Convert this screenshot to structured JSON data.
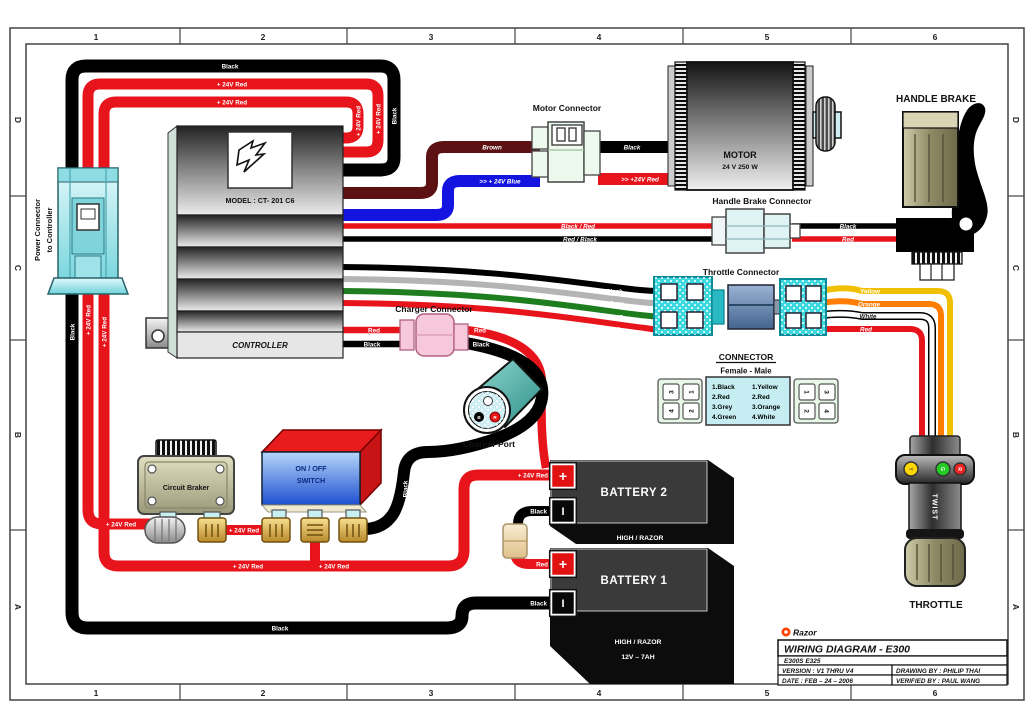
{
  "frame": {
    "columns": [
      "1",
      "2",
      "3",
      "4",
      "5",
      "6"
    ],
    "rows": [
      "D",
      "C",
      "B",
      "A"
    ]
  },
  "title_block": {
    "brand": "Razor",
    "title": "WIRING DIAGRAM - E300",
    "models": "E300S E325",
    "version": "VERSION : V1 THRU V4",
    "date": "DATE : FEB – 24 – 2006",
    "drawing_by": "DRAWING BY : PHILIP THAI",
    "verified_by": "VERIFIED BY : PAUL WANG"
  },
  "components": {
    "power_connector": {
      "label_line1": "Power Connector",
      "label_line2": "to Controller"
    },
    "controller": {
      "model": "MODEL : CT- 201 C6",
      "name": "CONTROLLER"
    },
    "motor_connector": {
      "label": "Motor Connector"
    },
    "motor": {
      "name": "MOTOR",
      "spec": "24 V 250 W"
    },
    "handle_brake": {
      "label": "HANDLE BRAKE"
    },
    "handle_brake_connector": {
      "label": "Handle Brake Connector"
    },
    "throttle_connector": {
      "label": "Throttle Connector"
    },
    "legend": {
      "title": "CONNECTOR",
      "subtitle": "Female  -  Male",
      "female_grid": [
        "3",
        "1",
        "4",
        "2"
      ],
      "male_grid": [
        "1",
        "3",
        "2",
        "4"
      ],
      "female_list": [
        "1.Black",
        "2.Red",
        "3.Grey",
        "4.Green"
      ],
      "male_list": [
        "1.Yellow",
        "2.Red",
        "3.Orange",
        "4.White"
      ]
    },
    "charger_connector": {
      "label": "Charger Connector"
    },
    "charger_port": {
      "label": "Charger Port",
      "pin_b": "B",
      "pin_r": "R"
    },
    "circuit_breaker": {
      "label": "Circuit Braker"
    },
    "power_switch": {
      "line1": "ON / OFF",
      "line2": "SWITCH"
    },
    "battery2": {
      "name": "BATTERY 2",
      "plus": "+",
      "minus": "I",
      "caption": "HIGH / RAZOR"
    },
    "battery1": {
      "name": "BATTERY 1",
      "plus": "+",
      "minus": "I",
      "caption1": "HIGH / RAZOR",
      "caption2": "12V – 7AH"
    },
    "throttle": {
      "label": "THROTTLE",
      "grip_text": "TWIST",
      "led_yellow": "Y",
      "led_green": "G",
      "led_red": "R"
    }
  },
  "wires": {
    "loop_black_top": "Black",
    "loop_red_outer": "+ 24V Red",
    "loop_red_inner": "+ 24V Red",
    "loop_red_inner_v": "+ 24V Red",
    "loop_red_outer_v": "+ 24V Red",
    "loop_black_v": "Black",
    "feed_black_v": "Black",
    "feed_red_outer_v": "+ 24V Red",
    "feed_red_inner_v": "+ 24V Red",
    "breaker_in": "+ 24V Red",
    "breaker_out": "+ 24V Red",
    "main_red_left": "+ 24V Red",
    "main_red_right": "+ 24V Red",
    "battery2_plus": "+ 24V Red",
    "battery2_minus": "Black",
    "fuse_to_b1": "Red",
    "battery1_minus": "Black",
    "ground_black": "Black",
    "switch_charger_black": "Black",
    "motor_brown": "Brown",
    "motor_blue": ">> + 24V Blue",
    "motor_black": "Black",
    "motor_red": ">> +24V Red",
    "brake_red": "Black / Red",
    "brake_black": "Red / Black",
    "brake_black2": "Black",
    "brake_red2": "Red",
    "throttle_black": "Black",
    "throttle_grey": "Grey",
    "throttle_green": "Green",
    "throttle_red": "Red",
    "throttle_yellow": "Yellow",
    "throttle_orange": "Orange",
    "throttle_white": "White",
    "throttle_red2": "Red",
    "charger_red_l": "Red",
    "charger_black_l": "Black",
    "charger_red_r": "Red",
    "charger_black_r": "Black"
  },
  "colors": {
    "red": "#e8141c",
    "black": "#000000",
    "brown": "#5c1212",
    "blue": "#1414e0",
    "yellow": "#f0c000",
    "orange": "#ff7d00",
    "white_wire": "#ffffff",
    "grey": "#b4b4b4",
    "green": "#1e7d1e",
    "connector_cyan": "#3cd8e0",
    "charger_pink": "#f5c2d7",
    "switch_blue": "#4a7de8",
    "switch_red": "#e81c1c",
    "battery_black": "#0c0c0c",
    "gold": "#e8c050",
    "brand_orange": "#ff4000"
  }
}
